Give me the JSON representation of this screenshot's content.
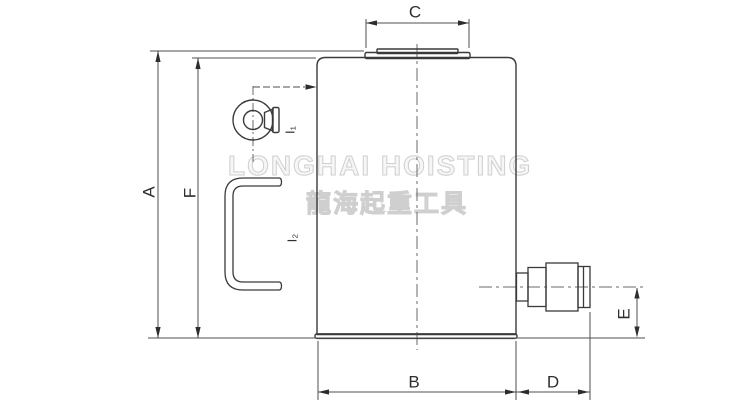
{
  "watermark": {
    "brand": "LONGHAI HOISTING",
    "brand_cn": "龍海起重工具"
  },
  "labels": {
    "a": "A",
    "b": "B",
    "c": "C",
    "d": "D",
    "e": "E",
    "f": "F",
    "i1": "I₁",
    "i2": "I₂"
  },
  "colors": {
    "line": "#3a3a3a",
    "dimension": "#4f4f4f",
    "centerline": "#6a6a6a",
    "arrow": "#2d2d2d",
    "watermark": "#cfcfcf",
    "label": "#2f2f2f",
    "background": "#ffffff"
  }
}
